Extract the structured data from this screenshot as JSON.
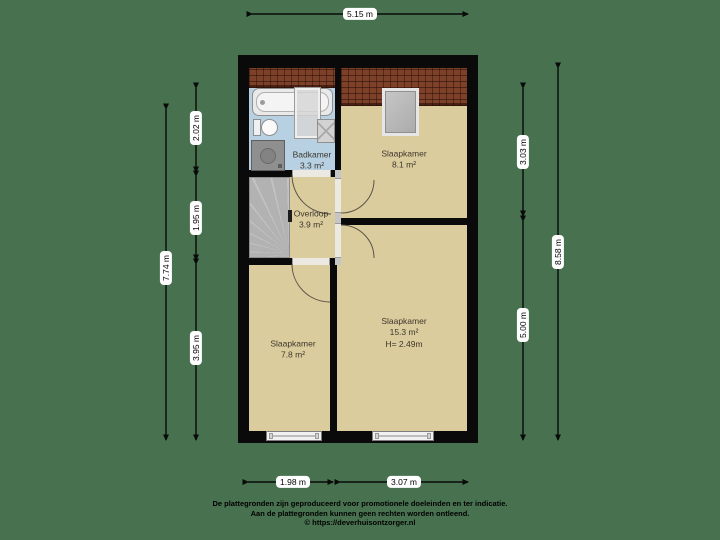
{
  "plan": {
    "type": "floorplan",
    "rooms": {
      "badkamer": {
        "name": "Badkamer",
        "area": "3.3 m²"
      },
      "slaapkamer_top": {
        "name": "Slaapkamer",
        "area": "8.1 m²"
      },
      "overloop": {
        "name": "Overloop",
        "area": "3.9 m²"
      },
      "slaapkamer_left": {
        "name": "Slaapkamer",
        "area": "7.8 m²"
      },
      "slaapkamer_right": {
        "name": "Slaapkamer",
        "area": "15.3 m²",
        "height": "H= 2.49m"
      }
    },
    "dimensions": {
      "top": {
        "label": "5.15 m"
      },
      "left_outer": {
        "label": "7.74 m"
      },
      "left_inner": [
        {
          "label": "2.02 m"
        },
        {
          "label": "1.95 m"
        },
        {
          "label": "3.95 m"
        }
      ],
      "right_inner": [
        {
          "label": "3.03 m"
        },
        {
          "label": "5.00 m"
        }
      ],
      "right_outer": {
        "label": "8.58 m"
      },
      "bottom": [
        {
          "label": "1.98 m"
        },
        {
          "label": "3.07 m"
        }
      ]
    },
    "fixtures": [
      "bathtub",
      "shower-glass",
      "shower-tray",
      "toilet",
      "washing-machine",
      "staircase",
      "dormer-window",
      "window",
      "window"
    ],
    "colors": {
      "background": "#47714F",
      "floor_beige": "#DBCC9E",
      "floor_blue": "#B7D1E3",
      "wall_black": "#0a0a0a",
      "roof_brown": "#7c4128",
      "stairs_gray": "#b6b6b6",
      "dim_pill_bg": "#ffffff",
      "label_text": "#3c372c"
    }
  },
  "footer": {
    "line1": "De plattegronden zijn geproduceerd voor promotionele doeleinden en ter indicatie.",
    "line2": "Aan de plattegronden kunnen geen rechten worden ontleend.",
    "line3": "© https://deverhuisontzorger.nl"
  }
}
